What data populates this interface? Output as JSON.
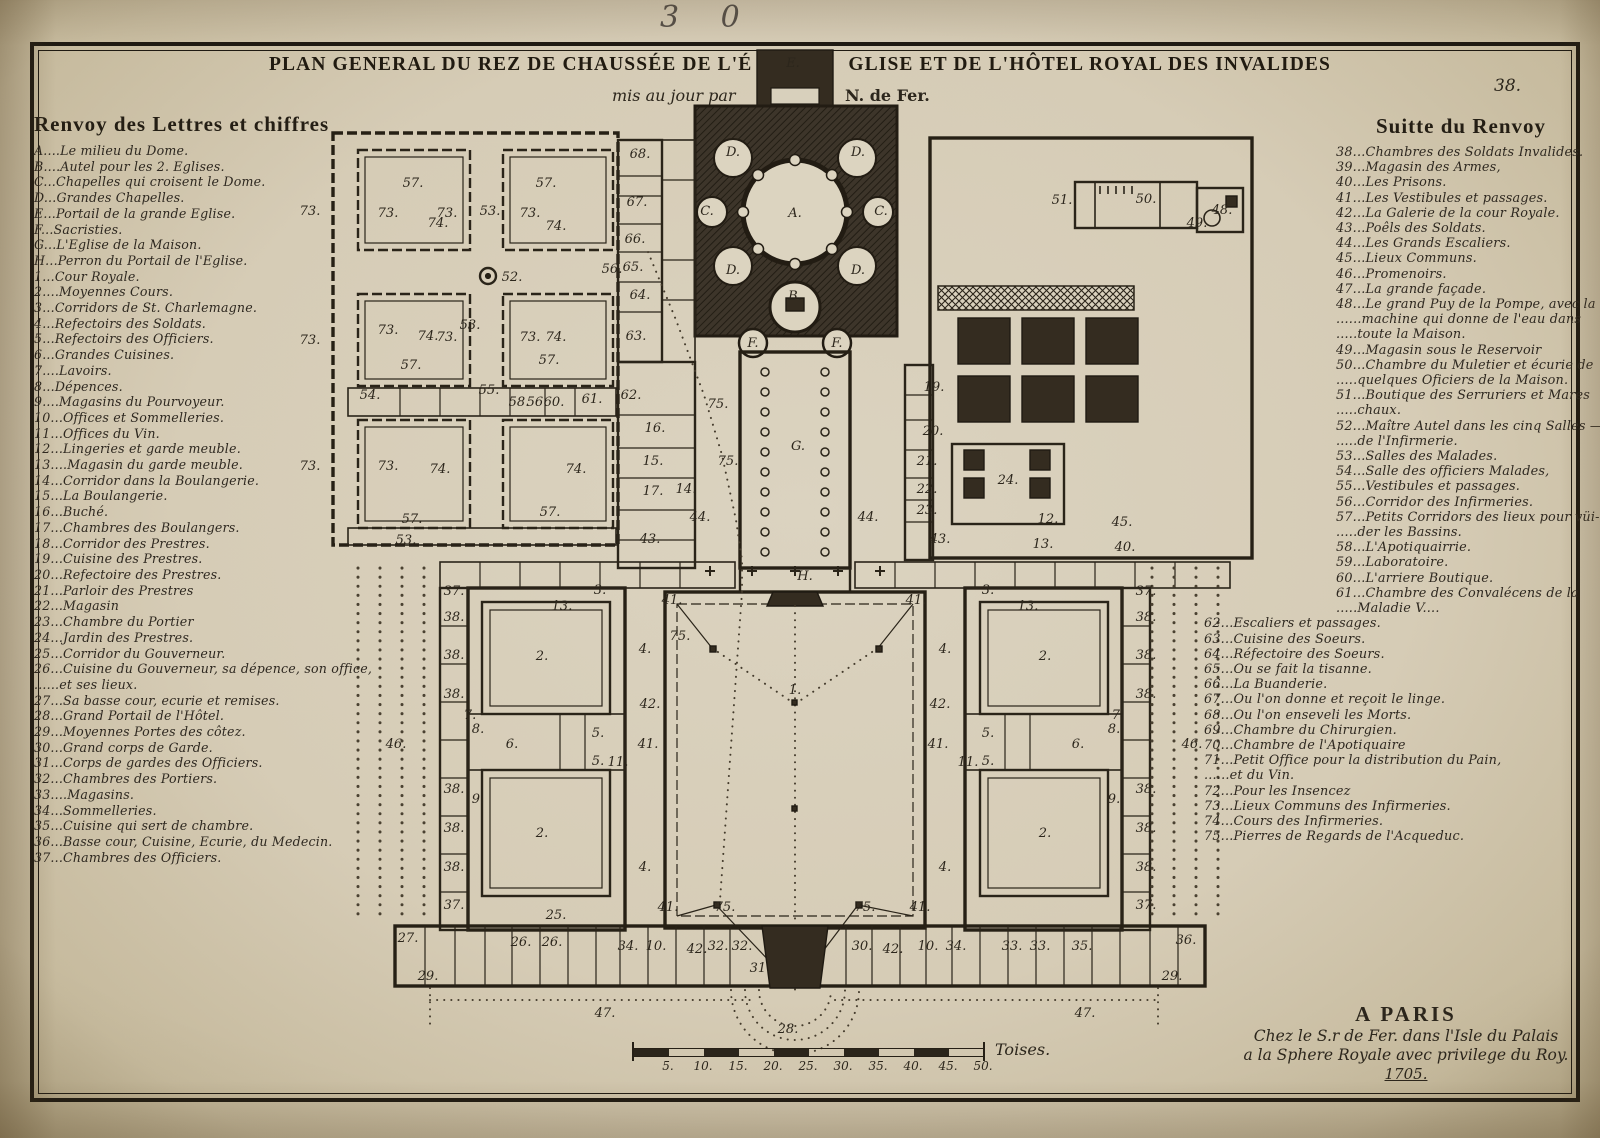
{
  "page": {
    "handwritten_number": "3 0",
    "plate_number": "38.",
    "title_part1": "PLAN GENERAL DU REZ DE CHAUSSÉE DE L'É",
    "title_part2": "GLISE ET DE L'HÔTEL ROYAL DES INVALIDES",
    "subtitle_left": "mis au jour par",
    "subtitle_right": "N. de Fer."
  },
  "legend_left": {
    "title": "Renvoy des Lettres et chiffres",
    "lines": [
      "A....Le milieu du Dome.",
      "B....Autel pour les 2. Eglises.",
      "C...Chapelles qui croisent le Dome.",
      "D...Grandes Chapelles.",
      "E...Portail de la grande Eglise.",
      "F...Sacristies.",
      "G...L'Eglise de la Maison.",
      "H...Perron du Portail de l'Eglise.",
      "1...Cour Royale.",
      "2....Moyennes Cours.",
      "3...Corridors de St. Charlemagne.",
      "4...Refectoirs des Soldats.",
      "5...Refectoirs des Officiers.",
      "6...Grandes Cuisines.",
      "7....Lavoirs.",
      "8...Dépences.",
      "9....Magasins du Pourvoyeur.",
      "10...Offices et Sommelleries.",
      "11...Offices du Vin.",
      "12...Lingeries et garde meuble.",
      "13....Magasin du garde meuble.",
      "14...Corridor dans la Boulangerie.",
      "15...La Boulangerie.",
      "16...Buché.",
      "17...Chambres des Boulangers.",
      "18...Corridor des Prestres.",
      "19...Cuisine des Prestres.",
      "20...Refectoire des Prestres.",
      "21...Parloir des Prestres",
      "22...Magasin",
      "23...Chambre du Portier",
      "24...Jardin des Prestres.",
      "25...Corridor du Gouverneur.",
      "26...Cuisine du Gouverneur, sa dépence, son office,",
      "......et ses lieux.",
      "27...Sa basse cour, ecurie et remises.",
      "28...Grand Portail de l'Hôtel.",
      "29...Moyennes Portes des côtez.",
      "30...Grand corps de Garde.",
      "31...Corps de gardes des Officiers.",
      "32...Chambres des Portiers.",
      "33....Magasins.",
      "34...Sommelleries.",
      "35...Cuisine qui sert de chambre.",
      "36...Basse cour, Cuisine, Ecurie, du Medecin.",
      "37...Chambres des Officiers."
    ]
  },
  "legend_right": {
    "title": "Suitte du Renvoy",
    "upper": [
      "38...Chambres des Soldats Invalides.",
      "39...Magasin des Armes,",
      "40...Les Prisons.",
      "41...Les Vestibules et passages.",
      "42...La Galerie de la cour Royale.",
      "43...Poêls des Soldats.",
      "44...Les Grands Escaliers.",
      "45...Lieux Communs.",
      "46...Promenoirs.",
      "47...La grande façade.",
      "48...Le grand Puy de la Pompe, avec la",
      "......machine qui donne de l'eau dans",
      ".....toute la Maison.",
      "49...Magasin sous le Reservoir",
      "50...Chambre du Muletier et écurie de",
      ".....quelques Oficiers de la Maison.",
      "51...Boutique des Serruriers et Mares",
      ".....chaux.",
      "52...Maître Autel dans les cinq Salles —",
      ".....de l'Infirmerie.",
      "53...Salles des Malades.",
      "54...Salle des officiers Malades,",
      "55...Vestibules et passages.",
      "56...Corridor des Infirmeries.",
      "57...Petits Corridors des lieux pour vüi-",
      ".....der les Bassins.",
      "58...L'Apotiquairrie.",
      "59...Laboratoire.",
      "60...L'arriere Boutique.",
      "61...Chambre des Convalécens de la",
      ".....Maladie V...."
    ],
    "lower": [
      "62...Escaliers et passages.",
      "63...Cuisine des Soeurs.",
      "64...Réfectoire des Soeurs.",
      "65...Ou se fait la tisanne.",
      "66...La Buanderie.",
      "67...Ou l'on donne et reçoit le linge.",
      "68...Ou l'on enseveli les Morts.",
      "69...Chambre du Chirurgien.",
      "70...Chambre de l'Apotiquaire",
      "71...Petit Office pour la distribution du Pain,",
      "......et du Vin.",
      "72...Pour les Insencez",
      "73...Lieux Communs des Infirmeries.",
      "74...Cours des Infirmeries.",
      "75...Pierres de Regards de l'Acqueduc."
    ]
  },
  "imprint": {
    "line1": "A PARIS",
    "line2": "Chez le S.r de Fer. dans l'Isle du Palais",
    "line3": "a la Sphere Royale avec privilege du Roy.",
    "line4": "1705."
  },
  "scalebar": {
    "ticks": [
      "5.",
      "10.",
      "15.",
      "20.",
      "25.",
      "30.",
      "35.",
      "40.",
      "45.",
      "50."
    ],
    "unit": "Toises."
  },
  "plan": {
    "labels": [
      {
        "x": 793,
        "y": 67,
        "t": "E.",
        "s": 11
      },
      {
        "x": 795,
        "y": 217,
        "t": "A.",
        "s": 16
      },
      {
        "x": 733,
        "y": 156,
        "t": "D.",
        "s": 12
      },
      {
        "x": 858,
        "y": 156,
        "t": "D.",
        "s": 12
      },
      {
        "x": 733,
        "y": 274,
        "t": "D.",
        "s": 12
      },
      {
        "x": 858,
        "y": 274,
        "t": "D.",
        "s": 12
      },
      {
        "x": 707,
        "y": 215,
        "t": "C.",
        "s": 12
      },
      {
        "x": 881,
        "y": 215,
        "t": "C.",
        "s": 12
      },
      {
        "x": 795,
        "y": 300,
        "t": "B.",
        "s": 13
      },
      {
        "x": 753,
        "y": 347,
        "t": "F.",
        "s": 12
      },
      {
        "x": 837,
        "y": 347,
        "t": "F.",
        "s": 12
      },
      {
        "x": 798,
        "y": 450,
        "t": "G.",
        "s": 14
      },
      {
        "x": 805,
        "y": 580,
        "t": "H.",
        "s": 13
      },
      {
        "x": 795,
        "y": 694,
        "t": "1.",
        "s": 17
      },
      {
        "x": 413,
        "y": 187,
        "t": "57."
      },
      {
        "x": 546,
        "y": 187,
        "t": "57."
      },
      {
        "x": 411,
        "y": 369,
        "t": "57."
      },
      {
        "x": 549,
        "y": 364,
        "t": "57."
      },
      {
        "x": 412,
        "y": 523,
        "t": "57."
      },
      {
        "x": 550,
        "y": 516,
        "t": "57."
      },
      {
        "x": 438,
        "y": 227,
        "t": "74."
      },
      {
        "x": 556,
        "y": 230,
        "t": "74."
      },
      {
        "x": 428,
        "y": 340,
        "t": "74."
      },
      {
        "x": 556,
        "y": 341,
        "t": "74."
      },
      {
        "x": 440,
        "y": 473,
        "t": "74."
      },
      {
        "x": 576,
        "y": 473,
        "t": "74."
      },
      {
        "x": 310,
        "y": 215,
        "t": "73."
      },
      {
        "x": 388,
        "y": 217,
        "t": "73."
      },
      {
        "x": 447,
        "y": 217,
        "t": "73."
      },
      {
        "x": 530,
        "y": 217,
        "t": "73."
      },
      {
        "x": 310,
        "y": 344,
        "t": "73."
      },
      {
        "x": 388,
        "y": 334,
        "t": "73."
      },
      {
        "x": 447,
        "y": 341,
        "t": "73."
      },
      {
        "x": 530,
        "y": 341,
        "t": "73."
      },
      {
        "x": 310,
        "y": 470,
        "t": "73."
      },
      {
        "x": 388,
        "y": 470,
        "t": "73."
      },
      {
        "x": 490,
        "y": 215,
        "t": "53."
      },
      {
        "x": 470,
        "y": 329,
        "t": "53."
      },
      {
        "x": 406,
        "y": 544,
        "t": "53."
      },
      {
        "x": 512,
        "y": 281,
        "t": "52."
      },
      {
        "x": 370,
        "y": 399,
        "t": "54."
      },
      {
        "x": 489,
        "y": 394,
        "t": "55."
      },
      {
        "x": 519,
        "y": 406,
        "t": "58.",
        "s": 10
      },
      {
        "x": 537,
        "y": 406,
        "t": "56.",
        "s": 10
      },
      {
        "x": 554,
        "y": 406,
        "t": "60.",
        "s": 10
      },
      {
        "x": 592,
        "y": 403,
        "t": "61.",
        "s": 11
      },
      {
        "x": 631,
        "y": 399,
        "t": "62.",
        "s": 11
      },
      {
        "x": 640,
        "y": 158,
        "t": "68."
      },
      {
        "x": 637,
        "y": 206,
        "t": "67."
      },
      {
        "x": 635,
        "y": 243,
        "t": "66."
      },
      {
        "x": 633,
        "y": 271,
        "t": "65."
      },
      {
        "x": 640,
        "y": 299,
        "t": "64."
      },
      {
        "x": 636,
        "y": 340,
        "t": "63."
      },
      {
        "x": 612,
        "y": 273,
        "t": "56.",
        "s": 10
      },
      {
        "x": 655,
        "y": 432,
        "t": "16.",
        "s": 12
      },
      {
        "x": 653,
        "y": 465,
        "t": "15.",
        "s": 12
      },
      {
        "x": 653,
        "y": 495,
        "t": "17.",
        "s": 12
      },
      {
        "x": 686,
        "y": 493,
        "t": "14.",
        "s": 11
      },
      {
        "x": 650,
        "y": 543,
        "t": "43.",
        "s": 12
      },
      {
        "x": 700,
        "y": 521,
        "t": "44.",
        "s": 12
      },
      {
        "x": 718,
        "y": 408,
        "t": "75.",
        "s": 12
      },
      {
        "x": 728,
        "y": 465,
        "t": "75.",
        "s": 12
      },
      {
        "x": 934,
        "y": 391,
        "t": "19.",
        "s": 12
      },
      {
        "x": 933,
        "y": 435,
        "t": "20.",
        "s": 12
      },
      {
        "x": 927,
        "y": 465,
        "t": "21.",
        "s": 11
      },
      {
        "x": 927,
        "y": 493,
        "t": "22.",
        "s": 10
      },
      {
        "x": 927,
        "y": 514,
        "t": "23.",
        "s": 10
      },
      {
        "x": 940,
        "y": 543,
        "t": "43.",
        "s": 12
      },
      {
        "x": 868,
        "y": 521,
        "t": "44.",
        "s": 12
      },
      {
        "x": 1008,
        "y": 484,
        "t": "24.",
        "s": 13
      },
      {
        "x": 1122,
        "y": 526,
        "t": "45.",
        "s": 11
      },
      {
        "x": 1125,
        "y": 551,
        "t": "40.",
        "s": 11
      },
      {
        "x": 1048,
        "y": 523,
        "t": "12.",
        "s": 11
      },
      {
        "x": 1043,
        "y": 548,
        "t": "13.",
        "s": 11
      },
      {
        "x": 1062,
        "y": 204,
        "t": "51."
      },
      {
        "x": 1146,
        "y": 203,
        "t": "50."
      },
      {
        "x": 1197,
        "y": 227,
        "t": "49.",
        "s": 10
      },
      {
        "x": 1222,
        "y": 214,
        "t": "48."
      },
      {
        "x": 542,
        "y": 660,
        "t": "2.",
        "s": 15
      },
      {
        "x": 542,
        "y": 837,
        "t": "2.",
        "s": 15
      },
      {
        "x": 1045,
        "y": 660,
        "t": "2.",
        "s": 15
      },
      {
        "x": 1045,
        "y": 837,
        "t": "2.",
        "s": 15
      },
      {
        "x": 645,
        "y": 653,
        "t": "4.",
        "s": 14
      },
      {
        "x": 645,
        "y": 871,
        "t": "4.",
        "s": 14
      },
      {
        "x": 945,
        "y": 653,
        "t": "4.",
        "s": 14
      },
      {
        "x": 945,
        "y": 871,
        "t": "4.",
        "s": 14
      },
      {
        "x": 512,
        "y": 748,
        "t": "6.",
        "s": 15
      },
      {
        "x": 1078,
        "y": 748,
        "t": "6.",
        "s": 15
      },
      {
        "x": 598,
        "y": 737,
        "t": "5.",
        "s": 12
      },
      {
        "x": 598,
        "y": 765,
        "t": "5.",
        "s": 12
      },
      {
        "x": 988,
        "y": 737,
        "t": "5.",
        "s": 12
      },
      {
        "x": 988,
        "y": 765,
        "t": "5.",
        "s": 12
      },
      {
        "x": 618,
        "y": 766,
        "t": "11.",
        "s": 10
      },
      {
        "x": 968,
        "y": 766,
        "t": "11.",
        "s": 10
      },
      {
        "x": 470,
        "y": 719,
        "t": "7.",
        "s": 11
      },
      {
        "x": 1118,
        "y": 719,
        "t": "7.",
        "s": 11
      },
      {
        "x": 672,
        "y": 604,
        "t": "41.",
        "s": 12
      },
      {
        "x": 916,
        "y": 604,
        "t": "41.",
        "s": 12
      },
      {
        "x": 668,
        "y": 911,
        "t": "41.",
        "s": 12
      },
      {
        "x": 920,
        "y": 911,
        "t": "41.",
        "s": 12
      },
      {
        "x": 648,
        "y": 748,
        "t": "41.",
        "s": 12
      },
      {
        "x": 938,
        "y": 748,
        "t": "41.",
        "s": 12
      },
      {
        "x": 650,
        "y": 708,
        "t": "42.",
        "s": 12
      },
      {
        "x": 940,
        "y": 708,
        "t": "42.",
        "s": 12
      },
      {
        "x": 697,
        "y": 953,
        "t": "42.",
        "s": 12
      },
      {
        "x": 893,
        "y": 953,
        "t": "42.",
        "s": 12
      },
      {
        "x": 396,
        "y": 748,
        "t": "46.",
        "s": 17
      },
      {
        "x": 1192,
        "y": 748,
        "t": "46.",
        "s": 17
      },
      {
        "x": 454,
        "y": 595,
        "t": "37.",
        "s": 10
      },
      {
        "x": 454,
        "y": 909,
        "t": "37.",
        "s": 10
      },
      {
        "x": 1146,
        "y": 595,
        "t": "37.",
        "s": 10
      },
      {
        "x": 1146,
        "y": 909,
        "t": "37.",
        "s": 10
      },
      {
        "x": 454,
        "y": 621,
        "t": "38.",
        "s": 10
      },
      {
        "x": 454,
        "y": 659,
        "t": "38.",
        "s": 10
      },
      {
        "x": 454,
        "y": 698,
        "t": "38.",
        "s": 10
      },
      {
        "x": 454,
        "y": 793,
        "t": "38.",
        "s": 10
      },
      {
        "x": 454,
        "y": 832,
        "t": "38.",
        "s": 10
      },
      {
        "x": 454,
        "y": 871,
        "t": "38.",
        "s": 10
      },
      {
        "x": 1146,
        "y": 621,
        "t": "38.",
        "s": 10
      },
      {
        "x": 1146,
        "y": 659,
        "t": "38.",
        "s": 10
      },
      {
        "x": 1146,
        "y": 698,
        "t": "38.",
        "s": 10
      },
      {
        "x": 1146,
        "y": 793,
        "t": "38.",
        "s": 10
      },
      {
        "x": 1146,
        "y": 832,
        "t": "38.",
        "s": 10
      },
      {
        "x": 1146,
        "y": 871,
        "t": "38.",
        "s": 10
      },
      {
        "x": 478,
        "y": 733,
        "t": "8.",
        "s": 11
      },
      {
        "x": 1114,
        "y": 733,
        "t": "8.",
        "s": 11
      },
      {
        "x": 478,
        "y": 803,
        "t": "9.",
        "s": 11
      },
      {
        "x": 1114,
        "y": 803,
        "t": "9.",
        "s": 11
      },
      {
        "x": 600,
        "y": 594,
        "t": "3.",
        "s": 11
      },
      {
        "x": 988,
        "y": 594,
        "t": "3.",
        "s": 11
      },
      {
        "x": 562,
        "y": 610,
        "t": "13.",
        "s": 10
      },
      {
        "x": 1028,
        "y": 610,
        "t": "13.",
        "s": 10
      },
      {
        "x": 556,
        "y": 919,
        "t": "25.",
        "s": 11
      },
      {
        "x": 680,
        "y": 640,
        "t": "75.",
        "s": 13
      },
      {
        "x": 725,
        "y": 911,
        "t": "75.",
        "s": 13
      },
      {
        "x": 865,
        "y": 911,
        "t": "75.",
        "s": 13
      },
      {
        "x": 408,
        "y": 942,
        "t": "27."
      },
      {
        "x": 428,
        "y": 980,
        "t": "29."
      },
      {
        "x": 521,
        "y": 946,
        "t": "26."
      },
      {
        "x": 552,
        "y": 946,
        "t": "26."
      },
      {
        "x": 628,
        "y": 950,
        "t": "34."
      },
      {
        "x": 656,
        "y": 950,
        "t": "10."
      },
      {
        "x": 718,
        "y": 950,
        "t": "32."
      },
      {
        "x": 742,
        "y": 950,
        "t": "32."
      },
      {
        "x": 760,
        "y": 972,
        "t": "31.",
        "s": 11
      },
      {
        "x": 862,
        "y": 950,
        "t": "30."
      },
      {
        "x": 928,
        "y": 950,
        "t": "10."
      },
      {
        "x": 956,
        "y": 950,
        "t": "34."
      },
      {
        "x": 1012,
        "y": 950,
        "t": "33."
      },
      {
        "x": 1040,
        "y": 950,
        "t": "33."
      },
      {
        "x": 1082,
        "y": 950,
        "t": "35."
      },
      {
        "x": 1186,
        "y": 944,
        "t": "36.",
        "s": 14
      },
      {
        "x": 1172,
        "y": 980,
        "t": "29."
      },
      {
        "x": 788,
        "y": 1033,
        "t": "28.",
        "s": 14
      },
      {
        "x": 605,
        "y": 1017,
        "t": "47.",
        "s": 14
      },
      {
        "x": 1085,
        "y": 1017,
        "t": "47.",
        "s": 14
      }
    ]
  }
}
